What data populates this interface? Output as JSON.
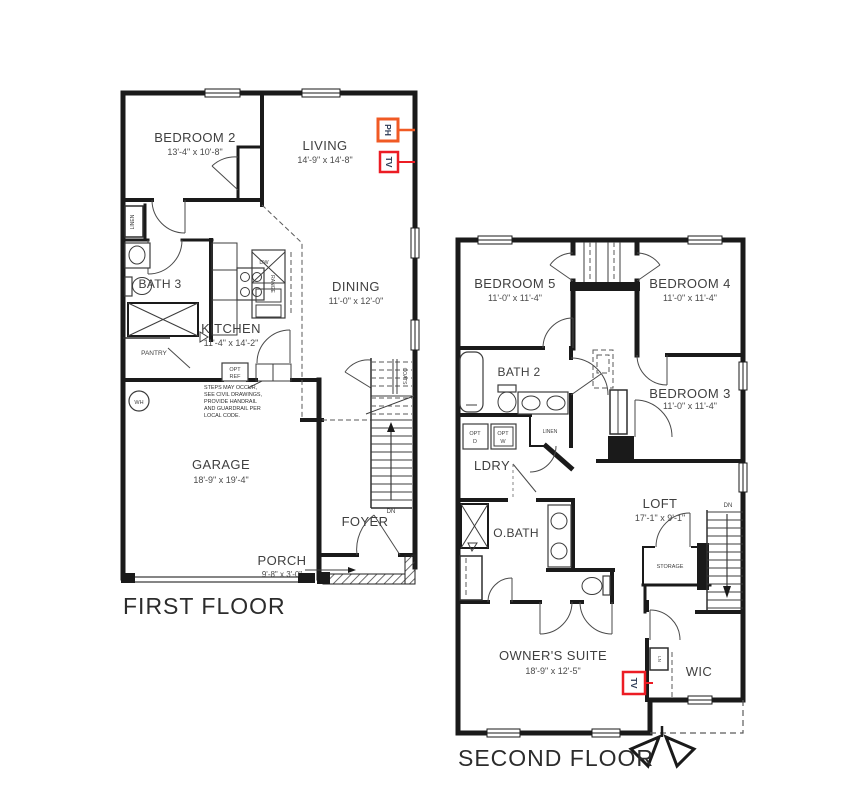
{
  "colors": {
    "wall": "#1a1a1a",
    "ph": "#f05a24",
    "tv": "#ec1c24",
    "marker_text": "#2b3a55"
  },
  "first_floor": {
    "title": "FIRST FLOOR",
    "rooms": {
      "bedroom2": {
        "name": "BEDROOM 2",
        "dims": "13'-4\" x 10'-8\""
      },
      "living": {
        "name": "LIVING",
        "dims": "14'-9\" x 14'-8\""
      },
      "dining": {
        "name": "DINING",
        "dims": "11'-0\" x 12'-0\""
      },
      "kitchen": {
        "name": "KITCHEN",
        "dims": "11'-4\" x 14'-2\""
      },
      "bath3": {
        "name": "BATH 3"
      },
      "garage": {
        "name": "GARAGE",
        "dims": "18'-9\" x 19'-4\""
      },
      "foyer": {
        "name": "FOYER"
      },
      "porch": {
        "name": "PORCH",
        "dims": "9'-8\" x 3'-0\""
      }
    },
    "labels": {
      "linen": "LINEN",
      "pantry": "PANTRY",
      "range": "RANGE",
      "dw": "DW",
      "opt_ref_1": "OPT",
      "opt_ref_2": "REF",
      "wh": "WH",
      "coats": "COATS",
      "dn": "DN"
    },
    "note_lines": [
      "STEPS MAY OCCUR,",
      "SEE CIVIL DRAWINGS,",
      "PROVIDE HANDRAIL",
      "AND GUARDRAIL PER",
      "LOCAL CODE."
    ],
    "markers": {
      "ph": "PH",
      "tv": "TV"
    }
  },
  "second_floor": {
    "title": "SECOND FLOOR",
    "rooms": {
      "bedroom5": {
        "name": "BEDROOM 5",
        "dims": "11'-0\" x 11'-4\""
      },
      "bedroom4": {
        "name": "BEDROOM 4",
        "dims": "11'-0\" x 11'-4\""
      },
      "bedroom3": {
        "name": "BEDROOM 3",
        "dims": "11'-0\" x 11'-4\""
      },
      "bath2": {
        "name": "BATH 2"
      },
      "ldry": {
        "name": "LDRY"
      },
      "obath": {
        "name": "O.BATH"
      },
      "loft": {
        "name": "LOFT",
        "dims": "17'-1\" x 9'-1\""
      },
      "owners_suite": {
        "name": "OWNER'S SUITE",
        "dims": "18'-9\" x 12'-5\""
      },
      "wic": {
        "name": "WIC"
      },
      "storage": {
        "name": "STORAGE"
      }
    },
    "labels": {
      "opt_d_1": "OPT",
      "opt_d_2": "D",
      "opt_w_1": "OPT",
      "opt_w_2": "W",
      "linen": "LINEN",
      "ln": "LN",
      "dn": "DN"
    },
    "markers": {
      "tv": "TV"
    }
  }
}
